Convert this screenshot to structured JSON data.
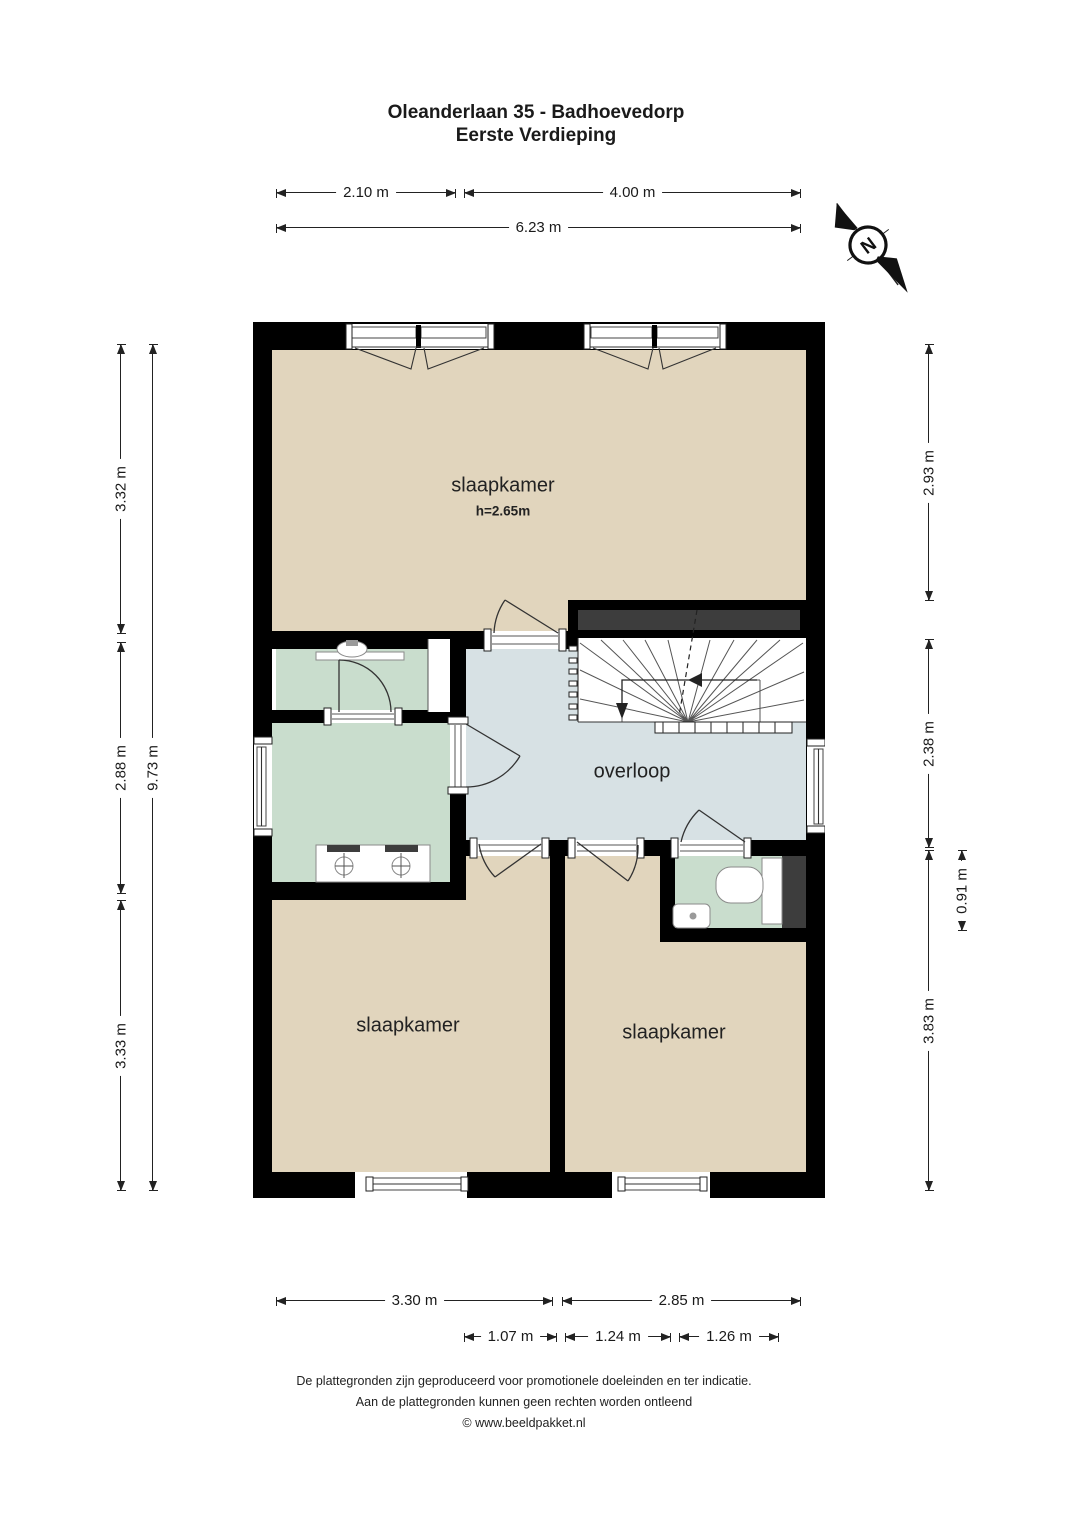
{
  "title": {
    "line1": "Oleanderlaan 35 - Badhoevedorp",
    "line2": "Eerste Verdieping"
  },
  "compass": {
    "label": "N"
  },
  "rooms": {
    "bedroom_top": {
      "label": "slaapkamer",
      "ceiling_note": "h=2.65m"
    },
    "landing": {
      "label": "overloop"
    },
    "bedroom_left": {
      "label": "slaapkamer"
    },
    "bedroom_right": {
      "label": "slaapkamer"
    }
  },
  "dims": {
    "top_left": "2.10 m",
    "top_right": "4.00 m",
    "top_total": "6.23 m",
    "left_top": "3.32 m",
    "left_mid": "2.88 m",
    "left_bottom": "3.33 m",
    "left_total": "9.73 m",
    "right_top": "2.93 m",
    "right_mid": "2.38 m",
    "right_toilet": "0.91 m",
    "right_bottom": "3.83 m",
    "bottom_left": "3.30 m",
    "bottom_right": "2.85 m",
    "bottom_s1": "1.07 m",
    "bottom_s2": "1.24 m",
    "bottom_s3": "1.26 m"
  },
  "footer": {
    "line1": "De plattegronden zijn geproduceerd voor promotionele doeleinden en ter indicatie.",
    "line2": "Aan de plattegronden kunnen geen rechten worden ontleend",
    "line3": "© www.beeldpakket.nl"
  },
  "colors": {
    "wall": "#000000",
    "room_beige": "#e1d5bd",
    "wet_green": "#c9ddcd",
    "landing_blue": "#d7e1e4",
    "shaft_grey": "#3d3d3d"
  }
}
